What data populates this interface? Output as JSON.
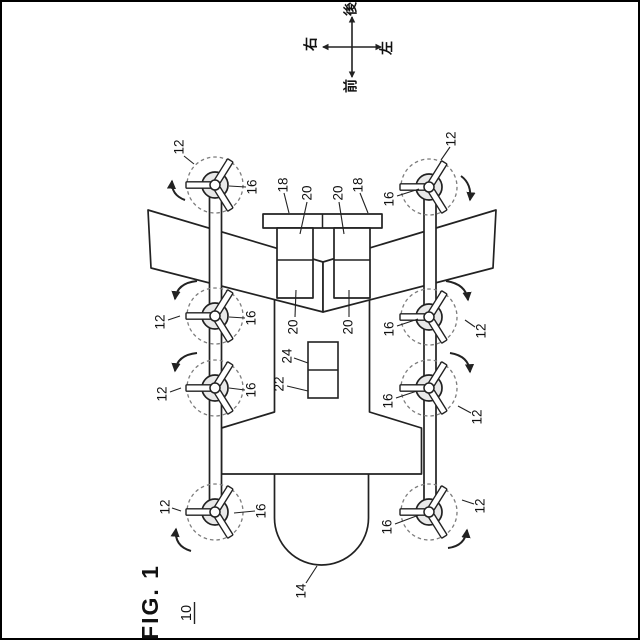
{
  "figure": {
    "title": "FIG. 1",
    "overall_ref": "10"
  },
  "compass": {
    "top": "後",
    "bottom": "前",
    "left": "右",
    "right": "左"
  },
  "ref_labels": {
    "rotor": "12",
    "nose": "14",
    "rotor_hub": "16",
    "tail_plane": "18",
    "tail_support": "20",
    "equipment_lower": "22",
    "equipment_upper": "24"
  }
}
